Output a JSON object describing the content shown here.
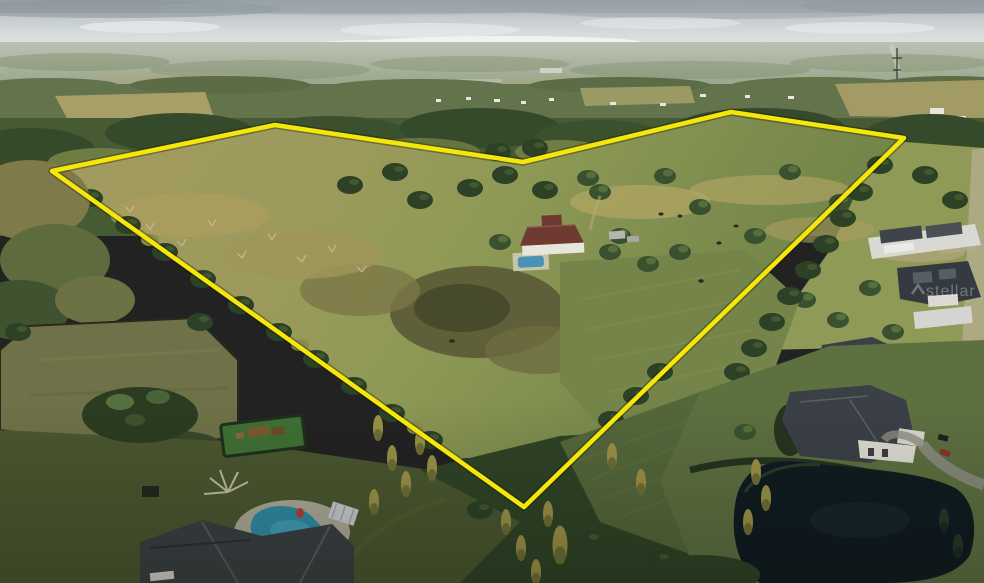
{
  "meta": {
    "image_type": "aerial-drone-photo",
    "description": "Late-afternoon aerial photo of a large rural parcel outlined in yellow; golden pasture and marsh inside the boundary with a red-roofed farmhouse and small pool; wooded edges; luxury estates with pools and a dark pond outside the boundary in the foreground; hazy tree-covered horizon."
  },
  "watermark": {
    "text": "stellar",
    "x": 926,
    "y": 296,
    "opacity": 0.3,
    "color": "#ffffff"
  },
  "boundary": {
    "color": "#f6e70a",
    "glow_color": "#141400",
    "stroke_width": 4.5,
    "glow_width": 7.5,
    "points": "52,171 275,125 523,162 731,112 904,138 524,507"
  },
  "palette": {
    "sky": "#c6cdd1",
    "cloud_dark": "#8f99a0",
    "cloud_bright": "#f3f5f3",
    "haze": "#a9b29e",
    "distant_forest": "#63734c",
    "forest": "#465a34",
    "forest_dark": "#30482a",
    "olive": "#6f7c44",
    "golden_field": "#a49a5c",
    "field_patch": "#999659",
    "marsh": "#5f6039",
    "marsh_dark": "#474b2c",
    "pasture_sun": "#97a057",
    "pasture_right": "#8e9a55",
    "pasture_shadow": "#54673a",
    "lawn_shadow": "#4a572f",
    "lawn_bottom_right": "#5d7040",
    "fenced_pasture": "#6f7248",
    "pond": "#0f1b21",
    "pool_farm": "#4a93b5",
    "pool_estate": "#2f8ca6",
    "farm_roof": "#6e3a32",
    "roof_dark": "#3a4046",
    "roof_gray": "#6a6f6a",
    "wall_white": "#e8e5db",
    "deck": "#cfc9b6",
    "driveway": "#b7ae92",
    "conifer_gold": "#9a9146",
    "playground_turf": "#3f7034",
    "play_structure": "#7a5a30",
    "car_red": "#8e2f28",
    "car_dark": "#1c2024",
    "dead_tree": "#c3b795"
  }
}
